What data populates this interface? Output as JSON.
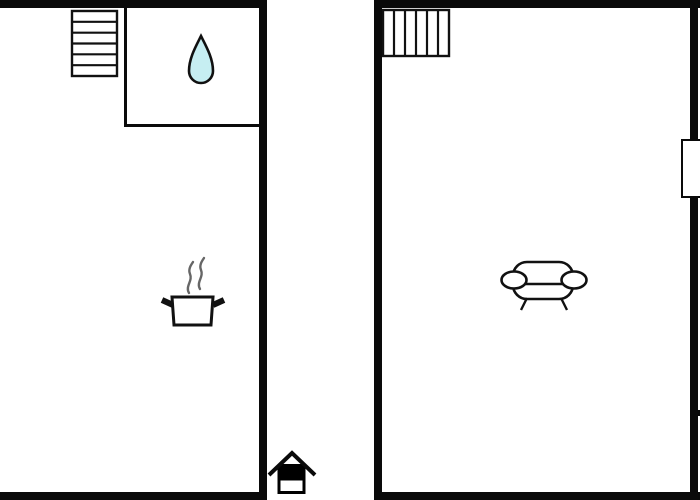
{
  "plan": {
    "type": "floor-plan",
    "rooms": [
      {
        "id": "left-room",
        "sub_rooms": [
          {
            "id": "bathroom-corner",
            "icon": "water-drop-icon"
          }
        ],
        "icons": [
          "staircase-horizontal-icon",
          "water-drop-icon",
          "cooking-pot-icon"
        ]
      },
      {
        "id": "right-room",
        "icons": [
          "staircase-vertical-icon",
          "sofa-icon"
        ],
        "features": [
          "window-right-wall"
        ]
      }
    ],
    "between_rooms_icon": "house-entrance-icon"
  },
  "icons": [
    {
      "name": "staircase-horizontal-icon",
      "glyph": "stairs",
      "steps": 6
    },
    {
      "name": "water-drop-icon",
      "glyph": "teardrop"
    },
    {
      "name": "cooking-pot-icon",
      "glyph": "pot-with-steam"
    },
    {
      "name": "staircase-vertical-icon",
      "glyph": "stairs",
      "steps": 6
    },
    {
      "name": "sofa-icon",
      "glyph": "couch"
    },
    {
      "name": "house-entrance-icon",
      "glyph": "house"
    }
  ],
  "colors": {
    "background": "#ffffff",
    "wall": "#0a0a0a",
    "line": "#111111",
    "drop_fill": "#c6eef2",
    "steam": "#666666",
    "house_roof": "#0a0a0a",
    "house_fill": "#000000"
  }
}
